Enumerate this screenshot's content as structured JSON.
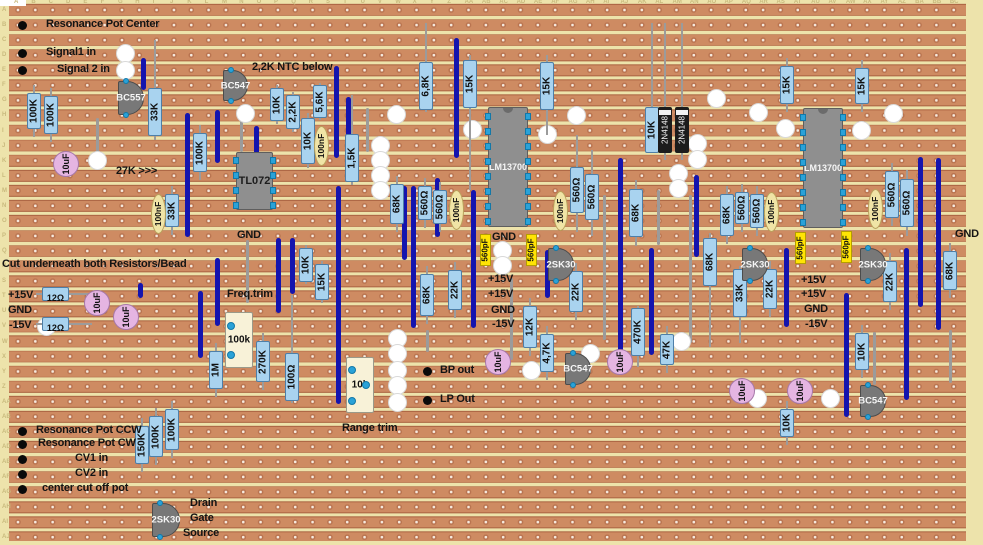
{
  "board": {
    "width": 983,
    "height": 545,
    "colors": {
      "substrate": "#EDE3AB",
      "strip": "#CE8B62",
      "strip_edge": "#A96140",
      "hole": "#F6EADF",
      "jumper": "#1414AE",
      "resistor": "#A9D3EF",
      "disc_cap": "#E5B5E2",
      "film_cap": "#F0E4A6",
      "ceramic_cap": "#FFE404",
      "ic_body": "#8f8f8f",
      "transistor": "#787878",
      "trimmer": "#F8F2D8",
      "pin": "#2AA2D8"
    },
    "row_labels": [
      "A",
      "B",
      "C",
      "D",
      "E",
      "F",
      "G",
      "H",
      "I",
      "J",
      "K",
      "L",
      "M",
      "N",
      "O",
      "P",
      "Q",
      "R",
      "S",
      "T",
      "U",
      "V",
      "W",
      "X",
      "Y",
      "Z",
      "AA",
      "AB",
      "AC",
      "AD",
      "AE",
      "AF",
      "AG",
      "AH",
      "AI",
      "AJ"
    ],
    "col_labels": [
      "A",
      "B",
      "C",
      "D",
      "E",
      "F",
      "G",
      "H",
      "I",
      "J",
      "K",
      "L",
      "M",
      "N",
      "O",
      "P",
      "Q",
      "R",
      "S",
      "T",
      "U",
      "V",
      "W",
      "X",
      "Y",
      "Z",
      "AA",
      "AB",
      "AC",
      "AD",
      "AE",
      "AF",
      "AG",
      "AH",
      "AI",
      "AJ",
      "AK",
      "AL",
      "AM",
      "AN",
      "AO",
      "AP",
      "AQ",
      "AR",
      "AS",
      "AT",
      "AU",
      "AV",
      "AW",
      "AX",
      "AY",
      "AZ",
      "BA",
      "BB",
      "BC"
    ]
  },
  "components": [
    {
      "t": "wire",
      "x": 97,
      "y": 118,
      "y2": 155
    },
    {
      "t": "wire",
      "x": 241,
      "y": 112,
      "y2": 152
    },
    {
      "t": "wire",
      "x": 367,
      "y": 108,
      "y2": 152
    },
    {
      "t": "wire",
      "x": 511,
      "y": 278,
      "y2": 360
    },
    {
      "t": "wire",
      "x": 604,
      "y": 195,
      "y2": 340
    },
    {
      "t": "wire",
      "x": 658,
      "y": 190,
      "y2": 245
    },
    {
      "t": "wire",
      "x": 690,
      "y": 195,
      "y2": 343
    },
    {
      "t": "wire",
      "x": 247,
      "y": 240,
      "y2": 303
    },
    {
      "t": "wire",
      "x": 427,
      "y": 330,
      "y2": 352
    },
    {
      "t": "wire",
      "x": 950,
      "y": 330,
      "y2": 383
    },
    {
      "t": "wire",
      "x": 874,
      "y": 332,
      "y2": 385
    },
    {
      "t": "cut",
      "x": 125,
      "y": 53
    },
    {
      "t": "cut",
      "x": 125,
      "y": 70
    },
    {
      "t": "cut",
      "x": 245,
      "y": 113
    },
    {
      "t": "cut",
      "x": 396,
      "y": 114
    },
    {
      "t": "cut",
      "x": 576,
      "y": 115
    },
    {
      "t": "cut",
      "x": 472,
      "y": 129
    },
    {
      "t": "cut",
      "x": 547,
      "y": 134
    },
    {
      "t": "cut",
      "x": 97,
      "y": 160
    },
    {
      "t": "cut",
      "x": 380,
      "y": 145
    },
    {
      "t": "cut",
      "x": 380,
      "y": 160
    },
    {
      "t": "cut",
      "x": 380,
      "y": 175
    },
    {
      "t": "cut",
      "x": 380,
      "y": 190
    },
    {
      "t": "cut",
      "x": 716,
      "y": 98
    },
    {
      "t": "cut",
      "x": 758,
      "y": 112
    },
    {
      "t": "cut",
      "x": 785,
      "y": 128
    },
    {
      "t": "cut",
      "x": 893,
      "y": 113
    },
    {
      "t": "cut",
      "x": 861,
      "y": 130
    },
    {
      "t": "cut",
      "x": 697,
      "y": 143
    },
    {
      "t": "cut",
      "x": 697,
      "y": 159
    },
    {
      "t": "cut",
      "x": 678,
      "y": 173
    },
    {
      "t": "cut",
      "x": 678,
      "y": 188
    },
    {
      "t": "cut",
      "x": 502,
      "y": 250
    },
    {
      "t": "cut",
      "x": 502,
      "y": 265
    },
    {
      "t": "cut",
      "x": 46,
      "y": 326
    },
    {
      "t": "cut",
      "x": 397,
      "y": 338
    },
    {
      "t": "cut",
      "x": 397,
      "y": 353
    },
    {
      "t": "cut",
      "x": 397,
      "y": 370
    },
    {
      "t": "cut",
      "x": 397,
      "y": 385
    },
    {
      "t": "cut",
      "x": 397,
      "y": 402
    },
    {
      "t": "cut",
      "x": 531,
      "y": 370
    },
    {
      "t": "cut",
      "x": 590,
      "y": 353
    },
    {
      "t": "cut",
      "x": 681,
      "y": 341
    },
    {
      "t": "cut",
      "x": 757,
      "y": 398
    },
    {
      "t": "cut",
      "x": 830,
      "y": 398
    },
    {
      "t": "jumper",
      "x": 143,
      "y": 58,
      "y2": 90
    },
    {
      "t": "jumper",
      "x": 187,
      "y": 113,
      "y2": 237
    },
    {
      "t": "jumper",
      "x": 217,
      "y": 110,
      "y2": 163
    },
    {
      "t": "jumper",
      "x": 256,
      "y": 126,
      "y2": 158
    },
    {
      "t": "jumper",
      "x": 336,
      "y": 66,
      "y2": 158
    },
    {
      "t": "jumper",
      "x": 348,
      "y": 97,
      "y2": 166
    },
    {
      "t": "jumper",
      "x": 456,
      "y": 38,
      "y2": 158
    },
    {
      "t": "jumper",
      "x": 404,
      "y": 186,
      "y2": 260
    },
    {
      "t": "jumper",
      "x": 413,
      "y": 186,
      "y2": 328
    },
    {
      "t": "jumper",
      "x": 338,
      "y": 186,
      "y2": 404
    },
    {
      "t": "jumper",
      "x": 217,
      "y": 258,
      "y2": 326
    },
    {
      "t": "jumper",
      "x": 200,
      "y": 291,
      "y2": 358
    },
    {
      "t": "jumper",
      "x": 278,
      "y": 238,
      "y2": 313
    },
    {
      "t": "jumper",
      "x": 292,
      "y": 238,
      "y2": 294
    },
    {
      "t": "jumper",
      "x": 140,
      "y": 283,
      "y2": 298
    },
    {
      "t": "jumper",
      "x": 437,
      "y": 178,
      "y2": 237
    },
    {
      "t": "jumper",
      "x": 473,
      "y": 190,
      "y2": 328
    },
    {
      "t": "jumper",
      "x": 547,
      "y": 250,
      "y2": 298
    },
    {
      "t": "jumper",
      "x": 620,
      "y": 158,
      "y2": 363
    },
    {
      "t": "jumper",
      "x": 651,
      "y": 248,
      "y2": 355
    },
    {
      "t": "jumper",
      "x": 696,
      "y": 175,
      "y2": 257
    },
    {
      "t": "jumper",
      "x": 786,
      "y": 248,
      "y2": 327
    },
    {
      "t": "jumper",
      "x": 846,
      "y": 293,
      "y2": 417
    },
    {
      "t": "jumper",
      "x": 906,
      "y": 248,
      "y2": 400
    },
    {
      "t": "jumper",
      "x": 920,
      "y": 157,
      "y2": 307
    },
    {
      "t": "jumper",
      "x": 938,
      "y": 158,
      "y2": 330
    },
    {
      "t": "res_v",
      "l": "100K",
      "x": 34,
      "y": 85,
      "y2": 137
    },
    {
      "t": "res_v",
      "l": "100K",
      "x": 51,
      "y": 88,
      "y2": 142
    },
    {
      "t": "res_v",
      "l": "33K",
      "x": 155,
      "y": 40,
      "y2": 140,
      "bh": 48,
      "bc": 112
    },
    {
      "t": "res_v",
      "l": "100K",
      "x": 200,
      "y": 125,
      "y2": 180
    },
    {
      "t": "res_v",
      "l": "33K",
      "x": 172,
      "y": 186,
      "y2": 235
    },
    {
      "t": "res_v",
      "l": "10K",
      "x": 277,
      "y": 85,
      "y2": 124,
      "bh": 33
    },
    {
      "t": "res_v",
      "l": "2,2K",
      "x": 293,
      "y": 92,
      "y2": 132,
      "bh": 34
    },
    {
      "t": "res_v",
      "l": "5,6K",
      "x": 320,
      "y": 83,
      "y2": 120,
      "bh": 33
    },
    {
      "t": "res_v",
      "l": "10K",
      "x": 308,
      "y": 113,
      "y2": 168,
      "bh": 46
    },
    {
      "t": "res_v",
      "l": "1,5K",
      "x": 352,
      "y": 95,
      "y2": 185,
      "bh": 48,
      "bc": 158
    },
    {
      "t": "res_v",
      "l": "6,8K",
      "x": 426,
      "y": 23,
      "y2": 112,
      "bh": 48,
      "bc": 86
    },
    {
      "t": "res_v",
      "l": "15K",
      "x": 470,
      "y": 55,
      "y2": 190,
      "bh": 48,
      "bc": 84
    },
    {
      "t": "res_v",
      "l": "15K",
      "x": 547,
      "y": 55,
      "y2": 135,
      "bh": 48,
      "bc": 86
    },
    {
      "t": "res_v",
      "l": "10K",
      "x": 652,
      "y": 23,
      "y2": 153,
      "bh": 46,
      "bc": 130
    },
    {
      "t": "res_v",
      "l": "15K",
      "x": 787,
      "y": 58,
      "y2": 112
    },
    {
      "t": "res_v",
      "l": "15K",
      "x": 862,
      "y": 60,
      "y2": 112
    },
    {
      "t": "res_v",
      "l": "68K",
      "x": 397,
      "y": 176,
      "y2": 232
    },
    {
      "t": "res_v",
      "l": "560Ω",
      "x": 425,
      "y": 178,
      "y2": 228
    },
    {
      "t": "res_v",
      "l": "560Ω",
      "x": 440,
      "y": 182,
      "y2": 232
    },
    {
      "t": "res_v",
      "l": "560Ω",
      "x": 577,
      "y": 135,
      "y2": 232,
      "bh": 46,
      "bc": 190
    },
    {
      "t": "res_v",
      "l": "560Ω",
      "x": 592,
      "y": 150,
      "y2": 236,
      "bh": 46,
      "bc": 197
    },
    {
      "t": "res_v",
      "l": "68K",
      "x": 636,
      "y": 180,
      "y2": 246
    },
    {
      "t": "res_v",
      "l": "68K",
      "x": 727,
      "y": 186,
      "y2": 244
    },
    {
      "t": "res_v",
      "l": "560Ω",
      "x": 742,
      "y": 184,
      "y2": 232
    },
    {
      "t": "res_v",
      "l": "560Ω",
      "x": 757,
      "y": 186,
      "y2": 236
    },
    {
      "t": "res_v",
      "l": "560Ω",
      "x": 892,
      "y": 163,
      "y2": 226
    },
    {
      "t": "res_v",
      "l": "560Ω",
      "x": 907,
      "y": 170,
      "y2": 236
    },
    {
      "t": "res_v",
      "l": "68K",
      "x": 950,
      "y": 243,
      "y2": 298
    },
    {
      "t": "res_v",
      "l": "10K",
      "x": 306,
      "y": 245,
      "y2": 284,
      "bh": 34
    },
    {
      "t": "res_v",
      "l": "15K",
      "x": 322,
      "y": 261,
      "y2": 303,
      "bh": 36
    },
    {
      "t": "res_v",
      "l": "68K",
      "x": 427,
      "y": 266,
      "y2": 324
    },
    {
      "t": "res_v",
      "l": "22K",
      "x": 455,
      "y": 262,
      "y2": 318
    },
    {
      "t": "res_v",
      "l": "12K",
      "x": 530,
      "y": 298,
      "y2": 356
    },
    {
      "t": "res_v",
      "l": "22K",
      "x": 576,
      "y": 263,
      "y2": 320
    },
    {
      "t": "res_v",
      "l": "68K",
      "x": 710,
      "y": 233,
      "y2": 347,
      "bh": 48,
      "bc": 262
    },
    {
      "t": "res_v",
      "l": "33K",
      "x": 740,
      "y": 266,
      "y2": 343,
      "bh": 48,
      "bc": 293
    },
    {
      "t": "res_v",
      "l": "22K",
      "x": 770,
      "y": 261,
      "y2": 317
    },
    {
      "t": "res_v",
      "l": "22K",
      "x": 890,
      "y": 253,
      "y2": 310
    },
    {
      "t": "res_v",
      "l": "470K",
      "x": 638,
      "y": 306,
      "y2": 367,
      "bh": 48,
      "bc": 332
    },
    {
      "t": "res_v",
      "l": "47K",
      "x": 667,
      "y": 326,
      "y2": 373
    },
    {
      "t": "res_v",
      "l": "4,7K",
      "x": 547,
      "y": 326,
      "y2": 380
    },
    {
      "t": "res_v",
      "l": "10K",
      "x": 862,
      "y": 325,
      "y2": 378
    },
    {
      "t": "res_v",
      "l": "10K",
      "x": 787,
      "y": 401,
      "y2": 445
    },
    {
      "t": "res_v",
      "l": "150K",
      "x": 142,
      "y": 418,
      "y2": 472
    },
    {
      "t": "res_v",
      "l": "100K",
      "x": 156,
      "y": 408,
      "y2": 465
    },
    {
      "t": "res_v",
      "l": "100K",
      "x": 172,
      "y": 401,
      "y2": 458
    },
    {
      "t": "res_v",
      "l": "1M",
      "x": 216,
      "y": 343,
      "y2": 397
    },
    {
      "t": "res_v",
      "l": "270K",
      "x": 263,
      "y": 333,
      "y2": 390
    },
    {
      "t": "res_v",
      "l": "100Ω",
      "x": 292,
      "y": 295,
      "y2": 403,
      "bh": 48,
      "bc": 377
    },
    {
      "t": "res_h",
      "l": "12Ω",
      "x": 36,
      "x2": 92,
      "y": 294
    },
    {
      "t": "res_h",
      "l": "12Ω",
      "x": 36,
      "x2": 92,
      "y": 324
    },
    {
      "t": "cap_film",
      "l": "100nF",
      "x": 321,
      "y": 146
    },
    {
      "t": "cap_film",
      "l": "100nF",
      "x": 158,
      "y": 214
    },
    {
      "t": "cap_film",
      "l": "100nF",
      "x": 456,
      "y": 210
    },
    {
      "t": "cap_film",
      "l": "100nF",
      "x": 560,
      "y": 211
    },
    {
      "t": "cap_film",
      "l": "100nF",
      "x": 771,
      "y": 212
    },
    {
      "t": "cap_film",
      "l": "100nF",
      "x": 875,
      "y": 209
    },
    {
      "t": "cap_cer",
      "l": "560pF",
      "x": 485,
      "y": 250
    },
    {
      "t": "cap_cer",
      "l": "560pF",
      "x": 531,
      "y": 250
    },
    {
      "t": "cap_cer",
      "l": "560pF",
      "x": 800,
      "y": 248
    },
    {
      "t": "cap_cer",
      "l": "560pF",
      "x": 846,
      "y": 247
    },
    {
      "t": "cap_disc",
      "l": "10uF",
      "x": 66,
      "y": 164
    },
    {
      "t": "cap_disc",
      "l": "10uF",
      "x": 97,
      "y": 303
    },
    {
      "t": "cap_disc",
      "l": "10uF",
      "x": 126,
      "y": 317
    },
    {
      "t": "cap_disc",
      "l": "10uF",
      "x": 498,
      "y": 362
    },
    {
      "t": "cap_disc",
      "l": "10uF",
      "x": 620,
      "y": 362
    },
    {
      "t": "cap_disc",
      "l": "10uF",
      "x": 742,
      "y": 391
    },
    {
      "t": "cap_disc",
      "l": "10uF",
      "x": 800,
      "y": 391
    },
    {
      "t": "diode",
      "l": "2N4148",
      "x": 665,
      "y": 23,
      "y2": 160,
      "bc": 130
    },
    {
      "t": "diode",
      "l": "2N4148",
      "x": 682,
      "y": 23,
      "y2": 160,
      "bc": 130
    },
    {
      "t": "ic",
      "l": "TL072",
      "x": 236,
      "y": 152,
      "w": 37,
      "h": 58,
      "pins": 4,
      "tc": "#1d1d1d",
      "fs": 11
    },
    {
      "t": "ic",
      "l": "LM13700",
      "x": 488,
      "y": 107,
      "w": 40,
      "h": 120,
      "pins": 8,
      "tc": "#f5f5f5",
      "fs": 9
    },
    {
      "t": "ic",
      "l": "LM13700",
      "x": 803,
      "y": 108,
      "w": 40,
      "h": 120,
      "pins": 8,
      "tc": "#f5f5f5",
      "fs": 9
    },
    {
      "t": "transistor",
      "l": "BC557",
      "x": 118,
      "y": 81,
      "w": 26,
      "h": 34
    },
    {
      "t": "transistor",
      "l": "BC547",
      "x": 223,
      "y": 70,
      "w": 25,
      "h": 31
    },
    {
      "t": "transistor",
      "l": "2SK30",
      "x": 548,
      "y": 248,
      "w": 26,
      "h": 33
    },
    {
      "t": "transistor",
      "l": "2SK30",
      "x": 742,
      "y": 248,
      "w": 26,
      "h": 33
    },
    {
      "t": "transistor",
      "l": "2SK30",
      "x": 860,
      "y": 248,
      "w": 26,
      "h": 33
    },
    {
      "t": "transistor",
      "l": "BC547",
      "x": 565,
      "y": 353,
      "w": 26,
      "h": 32
    },
    {
      "t": "transistor",
      "l": "BC547",
      "x": 860,
      "y": 385,
      "w": 26,
      "h": 32
    },
    {
      "t": "transistor",
      "l": "2SK30",
      "x": 152,
      "y": 503,
      "w": 28,
      "h": 34
    },
    {
      "t": "trimmer",
      "l": "100k",
      "x": 225,
      "y": 312,
      "w": 28,
      "h": 56,
      "dots": [
        [
          231,
          326
        ],
        [
          231,
          355
        ]
      ]
    },
    {
      "t": "trimmer",
      "l": "10k",
      "x": 346,
      "y": 357,
      "w": 28,
      "h": 56,
      "dots": [
        [
          352,
          370
        ],
        [
          366,
          385
        ],
        [
          352,
          401
        ]
      ]
    },
    {
      "t": "pad",
      "x": 22,
      "y": 25
    },
    {
      "t": "pad",
      "x": 22,
      "y": 53
    },
    {
      "t": "pad",
      "x": 22,
      "y": 70
    },
    {
      "t": "pad",
      "x": 427,
      "y": 371
    },
    {
      "t": "pad",
      "x": 427,
      "y": 400
    },
    {
      "t": "pad",
      "x": 22,
      "y": 431
    },
    {
      "t": "pad",
      "x": 22,
      "y": 444
    },
    {
      "t": "pad",
      "x": 22,
      "y": 459
    },
    {
      "t": "pad",
      "x": 22,
      "y": 474
    },
    {
      "t": "pad",
      "x": 22,
      "y": 489
    },
    {
      "t": "text",
      "l": "Resonance Pot Center",
      "x": 46,
      "y": 25
    },
    {
      "t": "text",
      "l": "Signal1 in",
      "x": 46,
      "y": 53
    },
    {
      "t": "text",
      "l": "Signal 2 in",
      "x": 57,
      "y": 70
    },
    {
      "t": "text",
      "l": "2,2K NTC below",
      "x": 252,
      "y": 68
    },
    {
      "t": "text",
      "l": "27K >>>",
      "x": 116,
      "y": 172
    },
    {
      "t": "text",
      "l": "GND",
      "x": 237,
      "y": 236
    },
    {
      "t": "text",
      "l": "Cut underneath both Resistors/Bead",
      "x": 2,
      "y": 265
    },
    {
      "t": "text",
      "l": "+15V",
      "x": 8,
      "y": 296
    },
    {
      "t": "text",
      "l": "GND",
      "x": 8,
      "y": 311
    },
    {
      "t": "text",
      "l": "-15V",
      "x": 9,
      "y": 326
    },
    {
      "t": "text",
      "l": "Freq.trim",
      "x": 227,
      "y": 295
    },
    {
      "t": "text",
      "l": "GND",
      "x": 492,
      "y": 238
    },
    {
      "t": "text",
      "l": "+15V",
      "x": 488,
      "y": 280
    },
    {
      "t": "text",
      "l": "+15V",
      "x": 488,
      "y": 295
    },
    {
      "t": "text",
      "l": "GND",
      "x": 491,
      "y": 311
    },
    {
      "t": "text",
      "l": "-15V",
      "x": 492,
      "y": 325
    },
    {
      "t": "text",
      "l": "+15V",
      "x": 801,
      "y": 281
    },
    {
      "t": "text",
      "l": "+15V",
      "x": 801,
      "y": 295
    },
    {
      "t": "text",
      "l": "GND",
      "x": 804,
      "y": 310
    },
    {
      "t": "text",
      "l": "-15V",
      "x": 805,
      "y": 325
    },
    {
      "t": "text",
      "l": "GND",
      "x": 955,
      "y": 235
    },
    {
      "t": "text",
      "l": "BP out",
      "x": 440,
      "y": 371
    },
    {
      "t": "text",
      "l": "LP Out",
      "x": 440,
      "y": 400
    },
    {
      "t": "text",
      "l": "Range trim",
      "x": 342,
      "y": 429
    },
    {
      "t": "text",
      "l": "Resonance Pot CCW",
      "x": 36,
      "y": 431
    },
    {
      "t": "text",
      "l": "Resonance Pot CW",
      "x": 38,
      "y": 444
    },
    {
      "t": "text",
      "l": "CV1 in",
      "x": 75,
      "y": 459
    },
    {
      "t": "text",
      "l": "CV2 in",
      "x": 75,
      "y": 474
    },
    {
      "t": "text",
      "l": "center cut off pot",
      "x": 42,
      "y": 489
    },
    {
      "t": "text",
      "l": "Drain",
      "x": 190,
      "y": 504
    },
    {
      "t": "text",
      "l": "Gate",
      "x": 190,
      "y": 519
    },
    {
      "t": "text",
      "l": "Source",
      "x": 183,
      "y": 534
    }
  ]
}
